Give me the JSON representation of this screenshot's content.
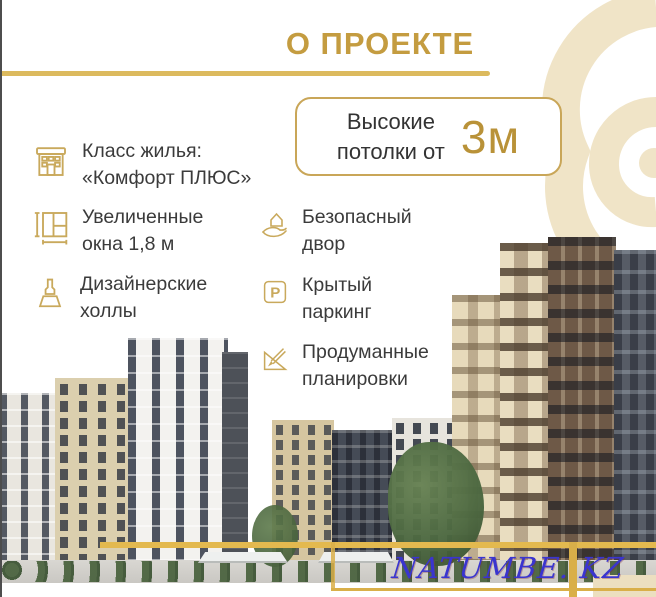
{
  "page": {
    "title": "О ПРОЕКТЕ"
  },
  "colors": {
    "accent_gold": "#C49C40",
    "underline_gold": "#DCBA5E",
    "icon_gold": "#C9A95C",
    "cream_spiral": "#F0E4C7",
    "text_dark": "#3B3B3B",
    "watermark_blue": "#3A35CF"
  },
  "ceiling_box": {
    "line1": "Высокие",
    "line2": "потолки от",
    "value": "3м"
  },
  "features_left": [
    {
      "icon": "building-icon",
      "line1": "Класс жилья:",
      "line2": "«Комфорт ПЛЮС»"
    },
    {
      "icon": "window-measure-icon",
      "line1": "Увеличенные",
      "line2": "окна 1,8 м"
    },
    {
      "icon": "paint-brush-icon",
      "line1": "Дизайнерские",
      "line2": "холлы"
    }
  ],
  "features_right": [
    {
      "icon": "hand-house-icon",
      "line1": "Безопасный",
      "line2": "двор"
    },
    {
      "icon": "parking-icon",
      "line1": "Крытый",
      "line2": "паркинг"
    },
    {
      "icon": "ruler-pencil-icon",
      "line1": "Продуманные",
      "line2": "планировки"
    }
  ],
  "icons": {
    "parking_glyph": "P"
  },
  "watermark": {
    "text": "NATUMBE. KZ"
  }
}
